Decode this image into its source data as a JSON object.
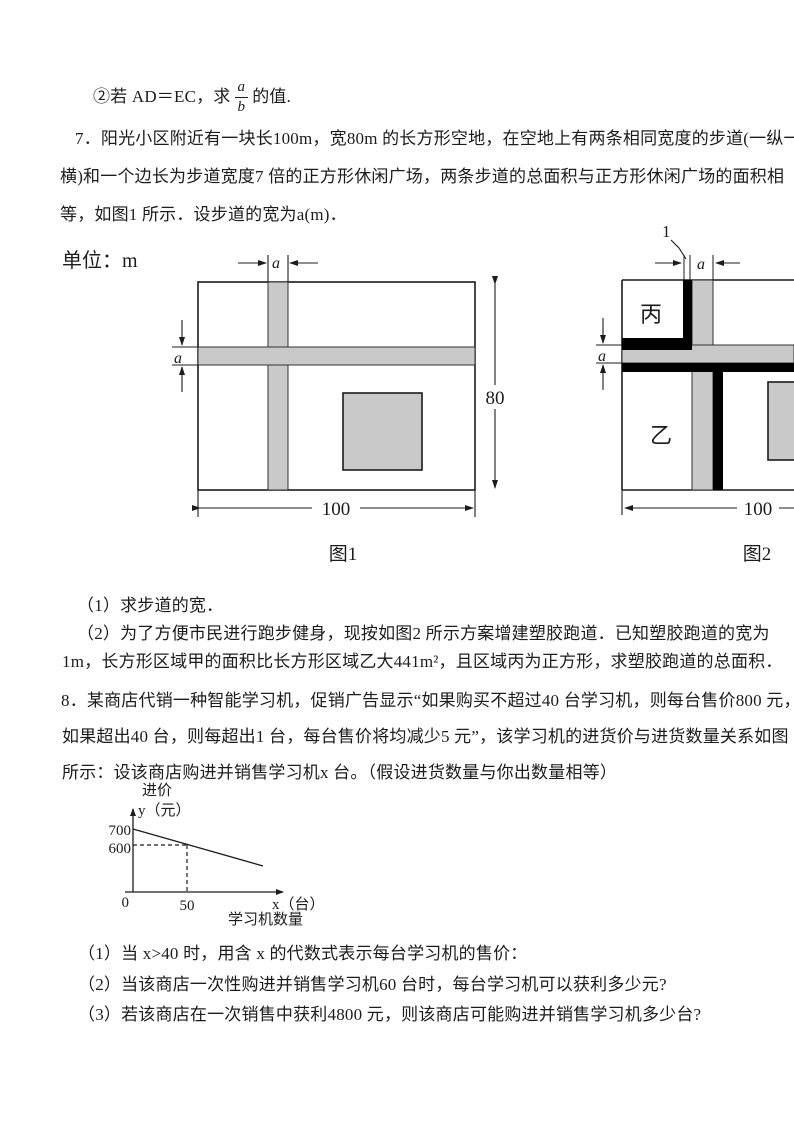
{
  "prelude": {
    "prefix": "②若 AD＝EC，求",
    "fraction": {
      "numerator": "a",
      "denominator": "b"
    },
    "suffix": "的值."
  },
  "problem7": {
    "lines": [
      "7．阳光小区附近有一块长100m，宽80m 的长方形空地，在空地上有两条相同宽度的步道(一纵一",
      "横)和一个边长为步道宽度7 倍的正方形休闲广场，两条步道的总面积与正方形休闲广场的面积相",
      "等，如图1 所示．设步道的宽为a(m)．"
    ],
    "subquestions": [
      "（1）求步道的宽．",
      "（2）为了方便市民进行跑步健身，现按如图2 所示方案增建塑胶跑道．已知塑胶跑道的宽为",
      "1m，长方形区域甲的面积比长方形区域乙大441m²，且区域丙为正方形，求塑胶跑道的总面积．"
    ]
  },
  "figure1": {
    "unit_label": "单位：m",
    "top_width_label": "a",
    "left_width_label": "a",
    "height_label": "80",
    "width_label": "100",
    "caption": "图1"
  },
  "figure2": {
    "track_width_label": "1",
    "top_width_label": "a",
    "left_width_label": "a",
    "region_top_left": "丙",
    "region_bottom_left": "乙",
    "width_label": "100",
    "caption": "图2"
  },
  "problem8": {
    "lines": [
      "8．某商店代销一种智能学习机，促销广告显示“如果购买不超过40 台学习机，则每台售价800 元，",
      "如果超出40 台，则每超出1 台，每台售价将均减少5 元”，该学习机的进货价与进货数量关系如图",
      "所示：设该商店购进并销售学习机x 台。（假设进货数量与你出数量相等）"
    ],
    "subquestions": [
      "（1）当 x>40 时，用含 x 的代数式表示每台学习机的售价：",
      "（2）当该商店一次性购进并销售学习机60 台时，每台学习机可以获利多少元?",
      "（3）若该商店在一次销售中获利4800 元，则该商店可能购进并销售学习机多少台?"
    ]
  },
  "graph": {
    "ylabel_top": "进价",
    "ylabel": "y（元）",
    "ytick_700": "700",
    "ytick_600": "600",
    "origin": "0",
    "xtick_50": "50",
    "xlabel": "x（台）",
    "xlabel_sub": "学习机数量"
  },
  "chart_data": {
    "type": "line",
    "title": "进货价与进货数量关系",
    "xlabel": "x（台） 学习机数量",
    "ylabel": "进价 y（元）",
    "xticks": [
      0,
      50
    ],
    "yticks": [
      600,
      700
    ],
    "series": [
      {
        "name": "进价",
        "x": [
          0,
          50
        ],
        "values": [
          700,
          600
        ]
      }
    ],
    "marked_point": {
      "x": 50,
      "y": 600,
      "guides": "dashed"
    },
    "trend": "linear decreasing, intercept 700, passes through (50,600)",
    "grid": false,
    "legend": "none"
  },
  "colors": {
    "walkway_gray": "#c9c9c9",
    "track_black": "#000000",
    "text": "#1c1c1c"
  }
}
